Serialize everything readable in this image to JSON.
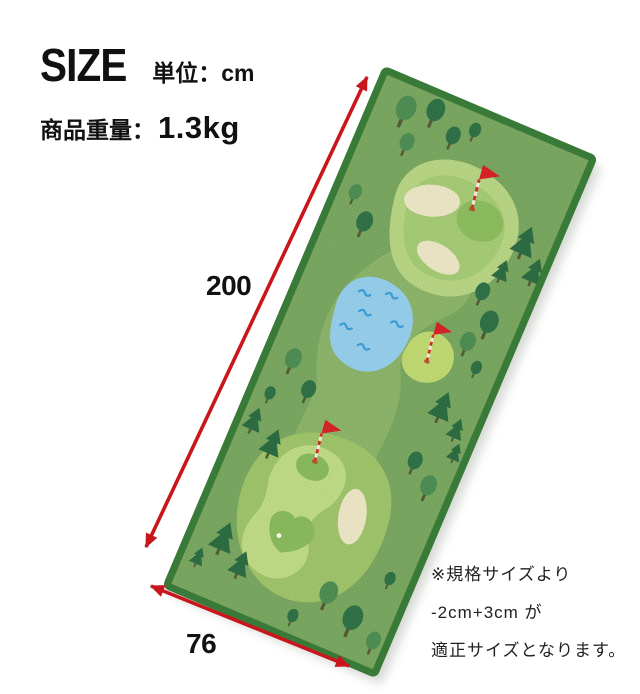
{
  "header": {
    "size_label": "SIZE",
    "unit_label": "単位：cm",
    "weight_label": "商品重量：",
    "weight_value": "1.3kg"
  },
  "diagram": {
    "length_cm": "200",
    "width_cm": "76",
    "subject": "golf-course putting mat, rotated product photo with dimension arrows"
  },
  "note": {
    "lines": [
      "※規格サイズより",
      "-2cm+3cm が",
      "適正サイズとなります。"
    ]
  },
  "icons": {
    "tree_deciduous": "ellipse-canopy-with-trunk",
    "tree_conifer": "triangle-pine-with-trunk",
    "flag": "red-pennant-on-striped-pole",
    "golf_ball": "white-dot",
    "water_wave": "blue-squiggle",
    "dimension_arrow": "double-headed-red-arrow"
  },
  "colors": {
    "accent_red": "#c9161d",
    "text": "#1a1a1a",
    "mat_base": "#77a45e",
    "mat_border": "#3a7a39",
    "fairway_light": "#b5d282",
    "fairway_mid": "#8ab168",
    "putting_green": "#8aba5c",
    "middle_green": "#bdd66f",
    "bunker_sand": "#e9e3c3",
    "pond_blue": "#93cbe8",
    "wave_blue": "#3a9bd5",
    "tree_dark": "#2b6a41",
    "tree_mid": "#4c8b51"
  }
}
